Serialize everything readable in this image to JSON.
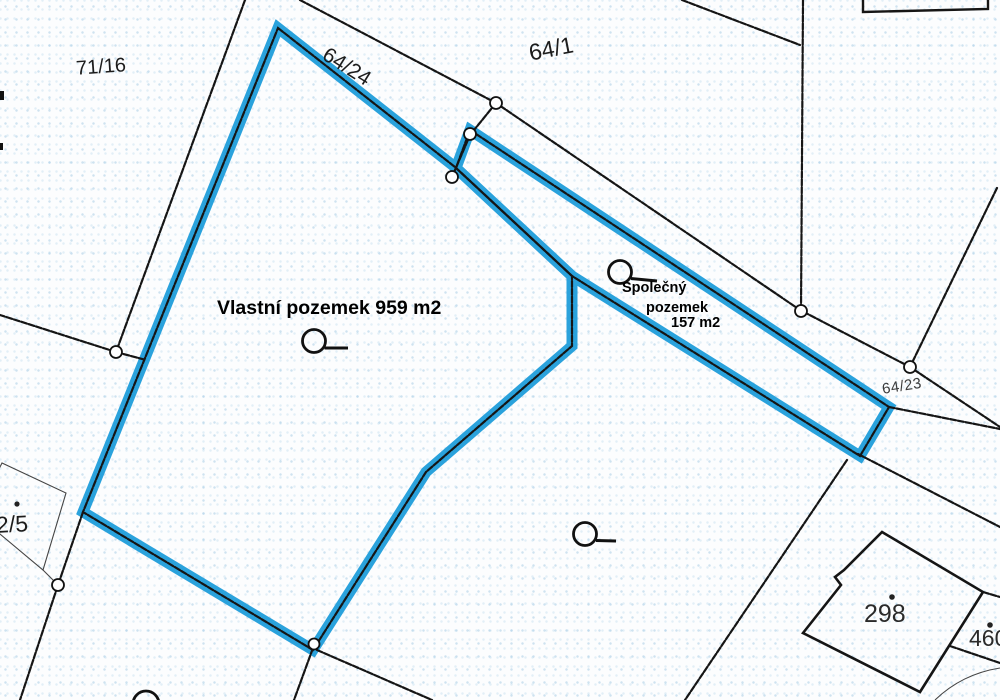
{
  "map": {
    "type": "cadastral parcel map",
    "highlight_color": "#2AA2DC",
    "line_color": "#151515",
    "parcel_labels": {
      "p71_16": "71/16",
      "p64_24": "64/24",
      "p64_1": "64/1",
      "p64_23": "64/23",
      "p298": "298",
      "p460": "460",
      "p2_5": "2/5"
    },
    "annotations": {
      "own_parcel_label": "Vlastní pozemek 959 m2",
      "shared_parcel_line1": "Společný",
      "shared_parcel_line2": "pozemek",
      "shared_parcel_line3": "157 m2"
    },
    "symbols": {
      "survey_point": "boundary-point-circle",
      "land_use": "orchard-loop-symbol",
      "building_dot": "building-centroid-dot"
    }
  }
}
